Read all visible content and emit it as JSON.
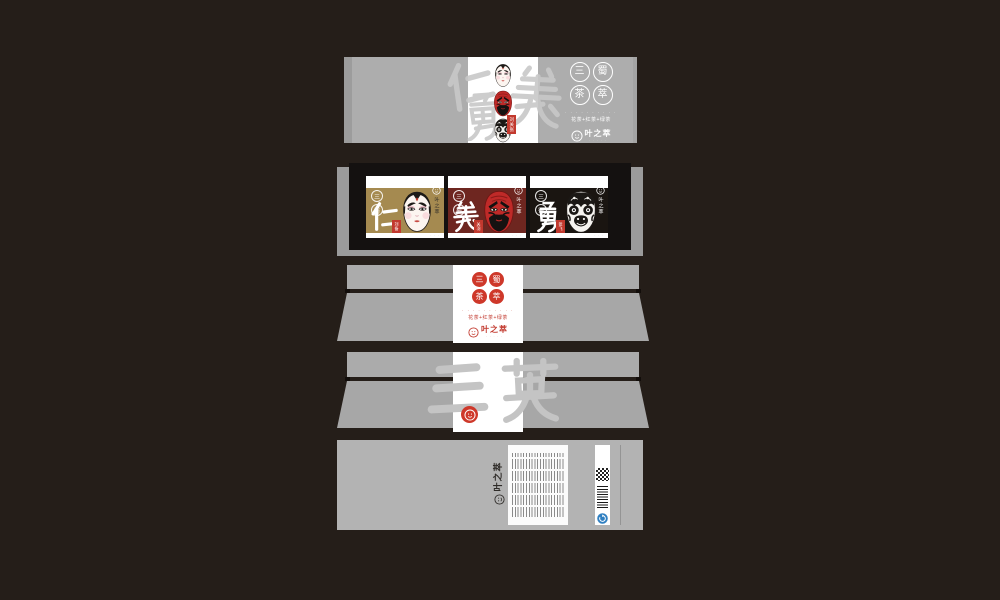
{
  "colors": {
    "board_bg": "#251e19",
    "panel_gray": "#adadad",
    "panel_gray_dark": "#9b9b9b",
    "white_strip": "#ffffff",
    "watermark_gray": "#c8c8c8",
    "frame_black": "#141110",
    "seal_red": "#ce382a",
    "brand_red": "#c2392e",
    "card_gold": "#a58a50",
    "card_maroon": "#6e2620",
    "card_black": "#1a1511",
    "recycle_blue": "#2f7fc1"
  },
  "brand": {
    "name": "叶之萃",
    "micro": "· · · · ·"
  },
  "product": {
    "seal_chars": [
      "三",
      "蜀",
      "茶",
      "萃"
    ],
    "caption": "· · · · · · · · · ·",
    "line": "花茶+红茶+绿茶"
  },
  "lid": {
    "watermark": "仁義勇",
    "tag": "刘关张",
    "masks": [
      "white-face-mask",
      "red-face-mask",
      "black-face-mask"
    ]
  },
  "cards": [
    {
      "virtue": "仁",
      "hero": "刘备",
      "bg": "#a58a50",
      "mask": "white-face-mask",
      "micro": "· · ·"
    },
    {
      "virtue": "義",
      "hero": "关羽",
      "bg": "#6e2620",
      "mask": "red-face-mask",
      "micro": "· · ·"
    },
    {
      "virtue": "勇",
      "hero": "张飞",
      "bg": "#1a1511",
      "mask": "black-face-mask",
      "micro": "· · ·"
    }
  ],
  "tray": {
    "watermark": "三英"
  },
  "back": {
    "brand": "叶之萃",
    "micro": "· · · ·",
    "fine_print": "illegible fine-print product information (rotated 90°)",
    "codes": [
      "qr-code",
      "barcode",
      "recycle-icon"
    ]
  }
}
